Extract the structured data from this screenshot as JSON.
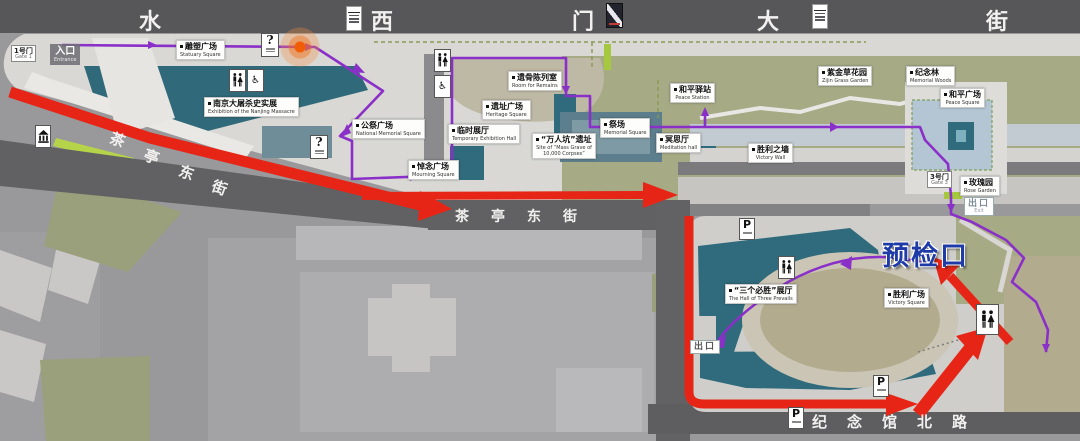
{
  "streets": {
    "top": [
      "水",
      "西",
      "门",
      "大",
      "街"
    ],
    "diagonal": [
      "茶",
      "亭",
      "东",
      "街"
    ],
    "mid": [
      "茶",
      "亭",
      "东",
      "街"
    ],
    "bottom": [
      "纪",
      "念",
      "馆",
      "北",
      "路"
    ]
  },
  "gates": {
    "gate1": {
      "zh": "1号门",
      "en": "Gate 1"
    },
    "entrance": {
      "zh": "入口",
      "en": "Entrance"
    },
    "gate3": {
      "zh": "3号门",
      "en": "Gate 3"
    },
    "exit_ne": {
      "zh": "出口",
      "en": "Exit"
    },
    "exit_sw": {
      "zh": "出口"
    },
    "precheck": {
      "zh": "预检口"
    }
  },
  "places": {
    "sculpture_square": {
      "zh": "雕塑广场",
      "en": "Statuary Square"
    },
    "massacre_exhibition": {
      "zh": "南京大屠杀史实展",
      "en": "Exhibition of the Nanjing Massacre"
    },
    "national_memorial_square": {
      "zh": "公祭广场",
      "en": "National Memorial Square"
    },
    "mourning_square": {
      "zh": "悼念广场",
      "en": "Mourning Square"
    },
    "temporary_hall": {
      "zh": "临时展厅",
      "en": "Temporary Exhibition Hall"
    },
    "remains_room": {
      "zh": "遗骨陈列室",
      "en": "Room for Remains"
    },
    "heritage_square": {
      "zh": "遗址广场",
      "en": "Heritage Square"
    },
    "mass_grave": {
      "zh": "“万人坑”遗址",
      "en": "Site of “Mass Grave of 10,000 Corpses”"
    },
    "memorial_square": {
      "zh": "祭场",
      "en": "Memorial Square"
    },
    "meditation_hall": {
      "zh": "冥思厅",
      "en": "Meditation hall"
    },
    "peace_station": {
      "zh": "和平驿站",
      "en": "Peace Station"
    },
    "zijin_garden": {
      "zh": "紫金草花园",
      "en": "Zijin Grass Garden"
    },
    "memorial_woods": {
      "zh": "纪念林",
      "en": "Memorial Woods"
    },
    "peace_square": {
      "zh": "和平广场",
      "en": "Peace Square"
    },
    "victory_wall": {
      "zh": "胜利之墙",
      "en": "Victory Wall"
    },
    "rose_garden": {
      "zh": "玫瑰园",
      "en": "Rose Garden"
    },
    "three_prevails_hall": {
      "zh": "“三个必胜”展厅",
      "en": "The Hall of Three Prevails"
    },
    "victory_square": {
      "zh": "胜利广场",
      "en": "Victory Square"
    }
  },
  "icons": {
    "parking": "P",
    "info": "?",
    "accessible": "♿"
  },
  "colors": {
    "route_purple": "#8b2fc9",
    "arrow_red": "#e62517",
    "precheck_blue": "#1d3aa6",
    "building_teal": "#2f6b7c",
    "park_green": "#a6aa85",
    "street_dark": "#57575a"
  }
}
